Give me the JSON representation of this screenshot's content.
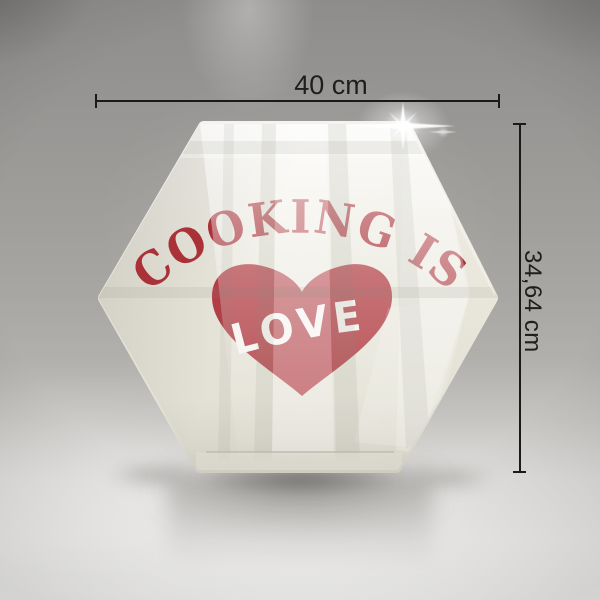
{
  "board": {
    "arc_text": "COOKING IS",
    "heart_text": "LOVE",
    "text_color": "#a93137",
    "heart_color": "#b13e44",
    "heart_text_color": "#f5f4ef",
    "surface_color": "#eceadf"
  },
  "dimensions": {
    "width": {
      "label": "40 cm"
    },
    "height": {
      "label": "34,64 cm"
    },
    "line_color": "#1a1a1a"
  },
  "icons": {
    "heart": "heart-shape",
    "sparkle": "lens-flare-sparkle"
  }
}
